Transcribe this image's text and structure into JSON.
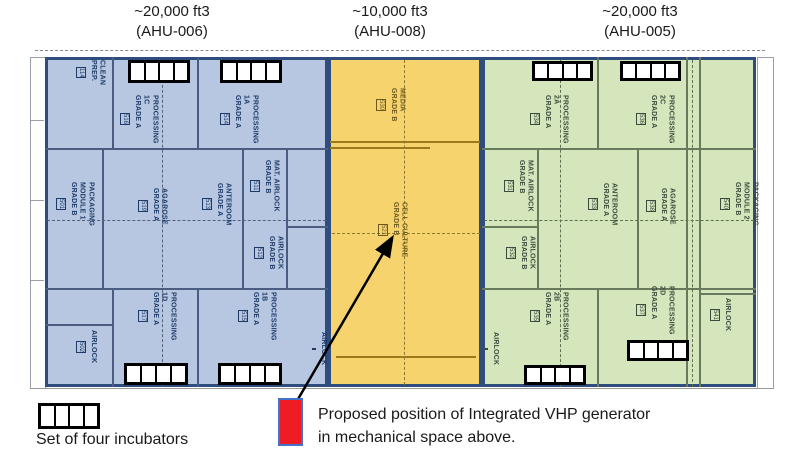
{
  "header": {
    "ahu_labels": [
      {
        "volume": "~20,000 ft3",
        "unit": "(AHU-006)"
      },
      {
        "volume": "~10,000 ft3",
        "unit": "(AHU-008)"
      },
      {
        "volume": "~20,000 ft3",
        "unit": "(AHU-005)"
      }
    ]
  },
  "floorplan": {
    "zones": [
      {
        "name": "AHU-006 zone",
        "rooms": [
          {
            "label": "CLEAN\nPREP.",
            "number": "114"
          },
          {
            "label": "PROCESSING\n1C\nGRADE A",
            "number": "516"
          },
          {
            "label": "PROCESSING\n1A\nGRADE A",
            "number": "514"
          },
          {
            "label": "PACKAGING\nMODULE 1\nGRADE B",
            "number": "501"
          },
          {
            "label": "AGAROSE\nGRADE A",
            "number": "519"
          },
          {
            "label": "ANTEROOM\nGRADE A",
            "number": "513"
          },
          {
            "label": "MAT. AIRLOCK\nGRADE B",
            "number": "511"
          },
          {
            "label": "AIRLOCK\nGRADE B",
            "number": "512"
          },
          {
            "label": "PROCESSING\n1D\nGRADE A",
            "number": "517"
          },
          {
            "label": "PROCESSING\n1B\nGRADE A",
            "number": "515"
          },
          {
            "label": "AIRLOCK",
            "number": "502"
          },
          {
            "label": "AIRLOCK",
            "number": ""
          }
        ]
      },
      {
        "name": "AHU-008 zone",
        "rooms": [
          {
            "label": "MEDIA\nGRADE B",
            "number": "530"
          },
          {
            "label": "CELL CULTURE\nGRADE B",
            "number": "521"
          }
        ]
      },
      {
        "name": "AHU-005 zone",
        "rooms": [
          {
            "label": "PROCESSING\n2A\nGRADE A",
            "number": "534"
          },
          {
            "label": "PROCESSING\n2C\nGRADE A",
            "number": "536"
          },
          {
            "label": "MAT. AIRLOCK\nGRADE B",
            "number": "531"
          },
          {
            "label": "AIRLOCK\nGRADE B",
            "number": "532"
          },
          {
            "label": "ANTEROOM\nGRADE A",
            "number": "533"
          },
          {
            "label": "AGAROSE\nGRADE A",
            "number": "538"
          },
          {
            "label": "PACKAGING\nMODULE 2\nGRADE B",
            "number": "540"
          },
          {
            "label": "PROCESSING\n2B\nGRADE A",
            "number": "535"
          },
          {
            "label": "PROCESSING\n2D\nGRADE A",
            "number": "537"
          },
          {
            "label": "AIRLOCK",
            "number": "541"
          },
          {
            "label": "AIRLOCK",
            "number": ""
          }
        ]
      }
    ]
  },
  "legend": {
    "incubator_label": "Set of four incubators",
    "vhp_label": "Proposed position of Integrated VHP generator\nin mechanical space above."
  },
  "icons": {
    "incubator_set": "set-of-four-incubators",
    "vhp_marker": "red-rectangle",
    "arrow": "black-arrow-to-cell-culture"
  },
  "colors": {
    "blue_zone_fill": "#b7c7e2",
    "yellow_zone_fill": "#f7d36e",
    "green_zone_fill": "#d5e6bd",
    "zone_border": "#2e4d7e",
    "blue_wall": "#4a5d80",
    "yellow_wall": "#9b7a1c",
    "green_wall": "#68795c",
    "blue_text": "#1d3b66",
    "yellow_text": "#6e5a1e",
    "green_text": "#3c4a3c",
    "vhp_marker_red": "#ee1c25",
    "vhp_marker_border": "#4472c4",
    "incubator_black": "#000000",
    "arrow_black": "#000000"
  }
}
